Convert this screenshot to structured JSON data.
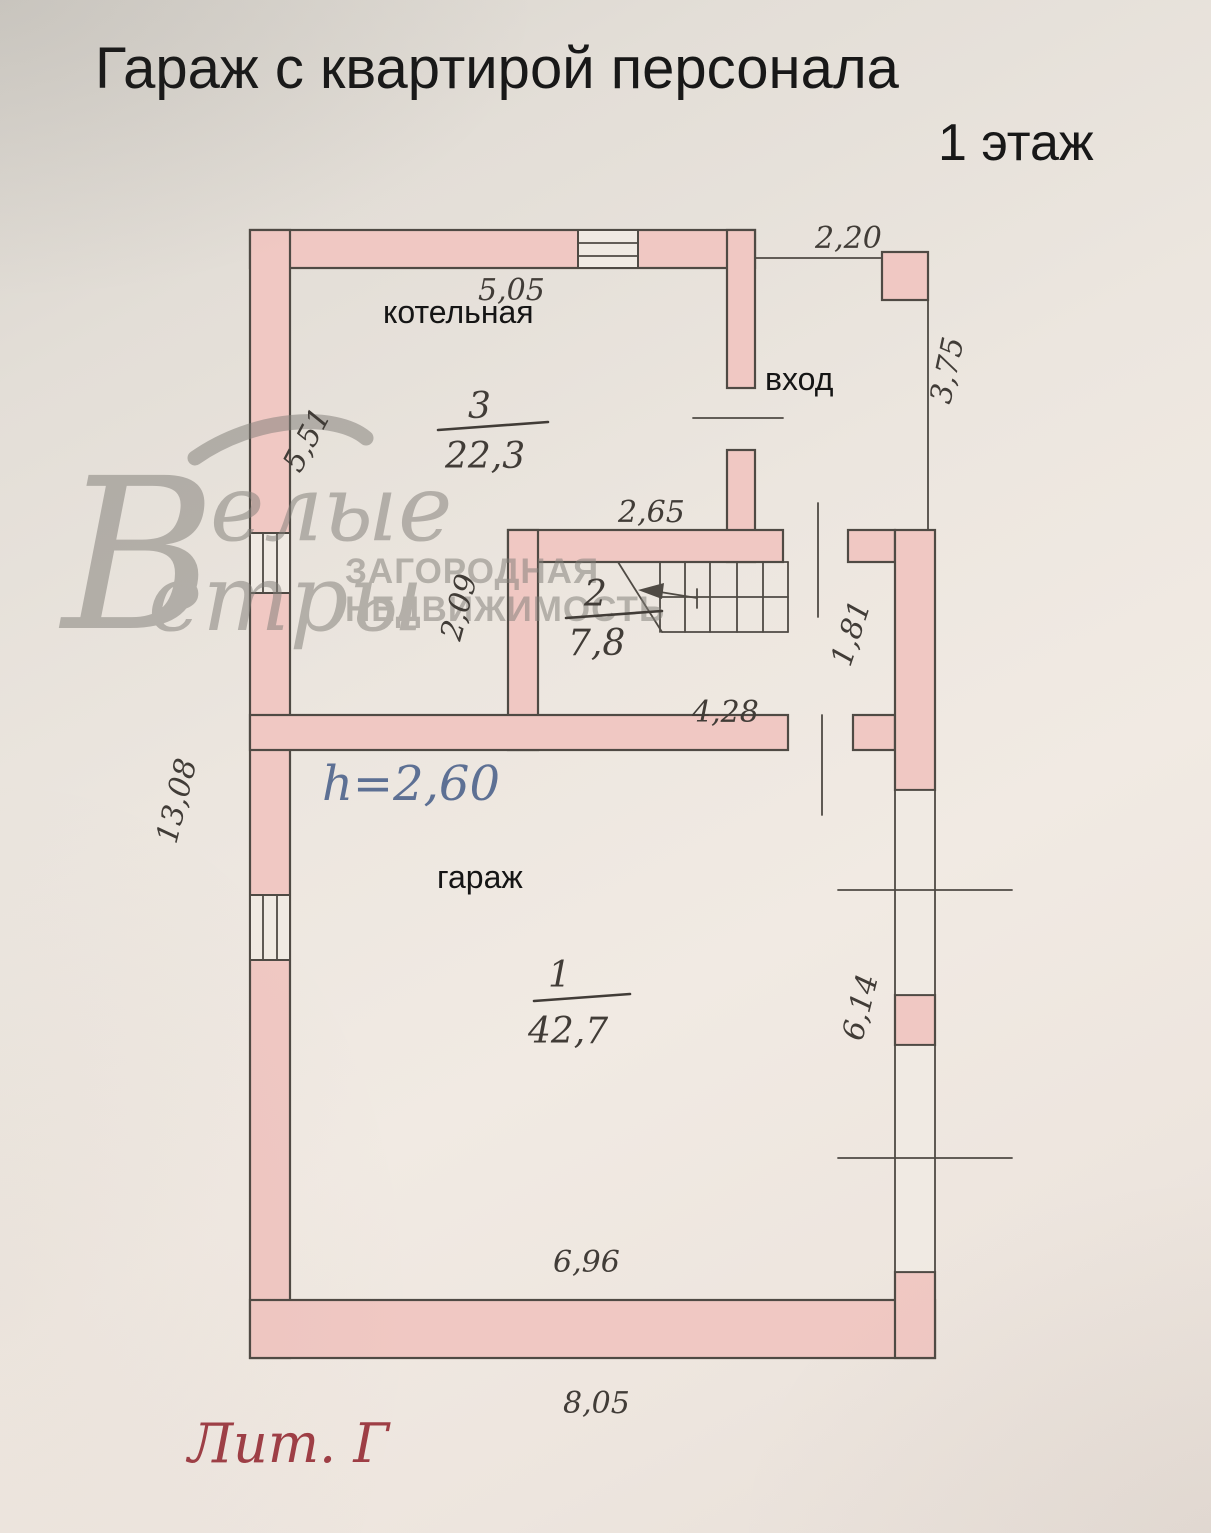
{
  "page": {
    "title": "Гараж с квартирой персонала",
    "floor": "1 этаж",
    "liter": "Лит. Г",
    "height_note": "h=2,60"
  },
  "watermark": {
    "initial": "В",
    "word1": "елые",
    "word2": "етры",
    "caps1": "ЗАГОРОДНАЯ",
    "caps2": "НЕДВИЖИМОСТЬ"
  },
  "rooms": {
    "boiler": {
      "label": "котельная",
      "number": "3",
      "area": "22,3"
    },
    "entrance": {
      "label": "вход"
    },
    "stairhall": {
      "number": "2",
      "area": "7,8"
    },
    "garage": {
      "label": "гараж",
      "number": "1",
      "area": "42,7"
    }
  },
  "dims": {
    "boiler_width": "5,05",
    "porch_width": "2,20",
    "porch_depth": "3,75",
    "boiler_left": "5,51",
    "boiler_inner": "2,65",
    "boiler_lower": "2,09",
    "stair_depth": "1,81",
    "stair_width": "4,28",
    "left_total": "13,08",
    "garage_right": "6,14",
    "garage_bottom_inner": "6,96",
    "bottom_total": "8,05"
  },
  "colors": {
    "wall": "#f0c8c3",
    "line": "#4f4a44",
    "dim_text": "#413c37",
    "height_note": "#5d7094",
    "liter": "#9e3e45",
    "watermark": "#827f79"
  }
}
